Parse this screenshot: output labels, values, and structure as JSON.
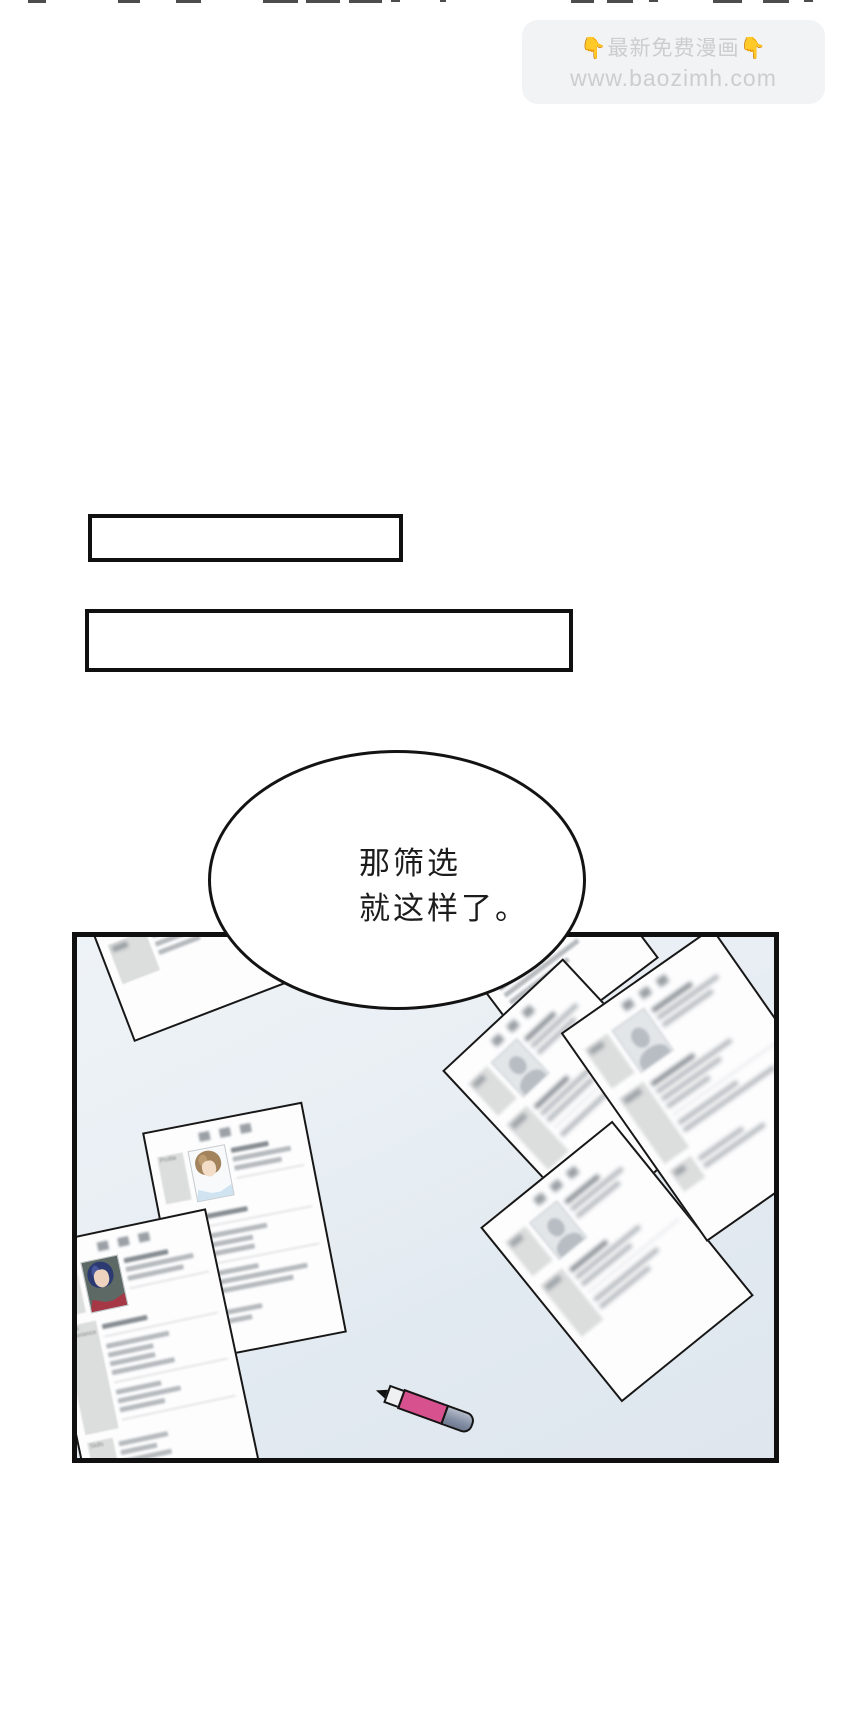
{
  "watermark": {
    "line1": "👇最新免费漫画👇",
    "line2": "www.baozimh.com"
  },
  "bubble": {
    "line1": "那筛选",
    "line2": "就这样了。"
  },
  "resume": {
    "profile": "Profile",
    "work": "Work Experience",
    "skills": "Skills"
  },
  "colors": {
    "panel_bg_top": "#eef3f7",
    "panel_bg_bottom": "#dfe6ee",
    "paper": "#fdfdfe",
    "label_gray": "#dcdddd",
    "pen_pink": "#d8518f",
    "pen_cap_gray": "#8791a6",
    "woman_hair_navy": "#2c3a72",
    "woman_top_red": "#a63744",
    "man_hair_brown": "#a3835c",
    "man_shirt_blue": "#cfe3f0",
    "outline_black": "#101010",
    "watermark_text": "#cccdcf"
  }
}
